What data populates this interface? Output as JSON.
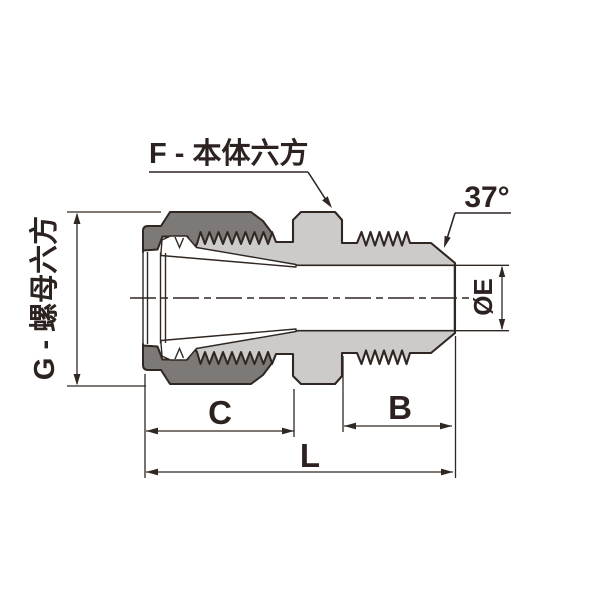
{
  "drawing": {
    "callouts": {
      "body_hex": "F - 本体六方",
      "nut_hex": "G - 螺母六方",
      "flare_angle": "37°",
      "end_diameter": "ØE"
    },
    "dimensions": {
      "c": "C",
      "b": "B",
      "l": "L"
    },
    "colors": {
      "body_fill": "#cccbc9",
      "nut_fill": "#7c7977",
      "ferrule_fill": "#ffffff",
      "outline": "#302723",
      "background": "#ffffff"
    }
  }
}
